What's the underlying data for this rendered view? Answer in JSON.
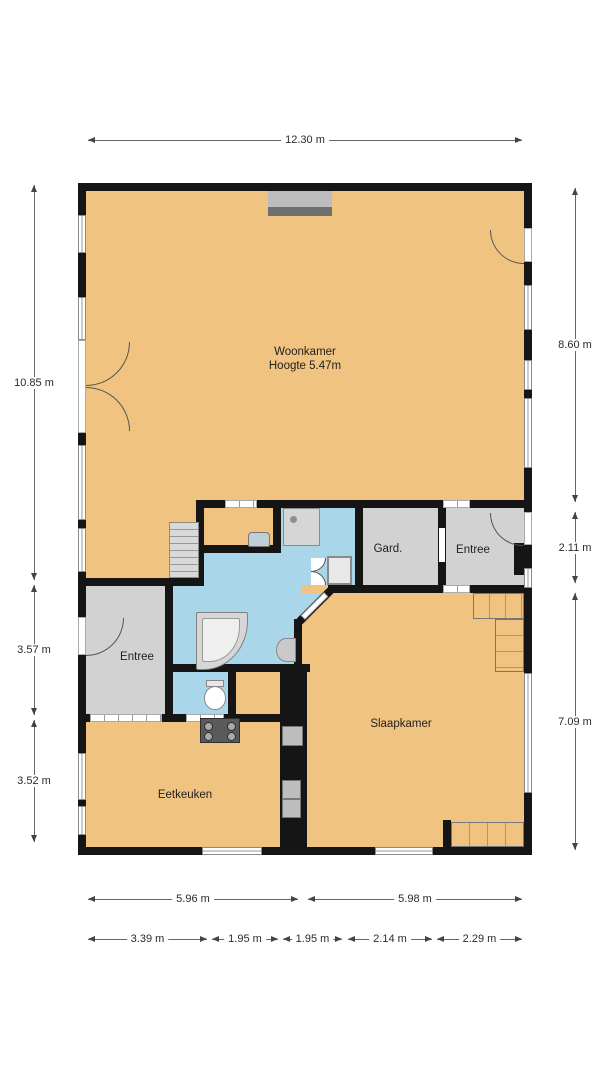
{
  "plan": {
    "rooms": {
      "woonkamer": {
        "name": "Woonkamer",
        "height_note": "Hoogte 5.47m"
      },
      "gard": {
        "name": "Gard."
      },
      "entree_right": {
        "name": "Entree"
      },
      "entree_left": {
        "name": "Entree"
      },
      "slaapkamer": {
        "name": "Slaapkamer"
      },
      "eetkeuken": {
        "name": "Eetkeuken"
      }
    },
    "dimensions": {
      "top": "12.30 m",
      "left": [
        "10.85 m",
        "3.57 m",
        "3.52 m"
      ],
      "right": [
        "8.60 m",
        "2.11 m",
        "7.09 m"
      ],
      "bottom_row1": [
        "5.96 m",
        "5.98 m"
      ],
      "bottom_row2": [
        "3.39 m",
        "1.95 m",
        "1.95 m",
        "2.14 m",
        "2.29 m"
      ]
    },
    "icons": [
      "stairs",
      "shower",
      "bathtub",
      "toilet",
      "sink",
      "washbasin",
      "stove",
      "oven",
      "fireplace",
      "wardrobe",
      "bench",
      "closet"
    ],
    "colors": {
      "room_orange": "#F1C381",
      "bath_blue": "#A9D7E9",
      "hall_gray": "#D2D2D2",
      "wall_black": "#151515",
      "fixture_gray": "#D6D6D6"
    }
  }
}
